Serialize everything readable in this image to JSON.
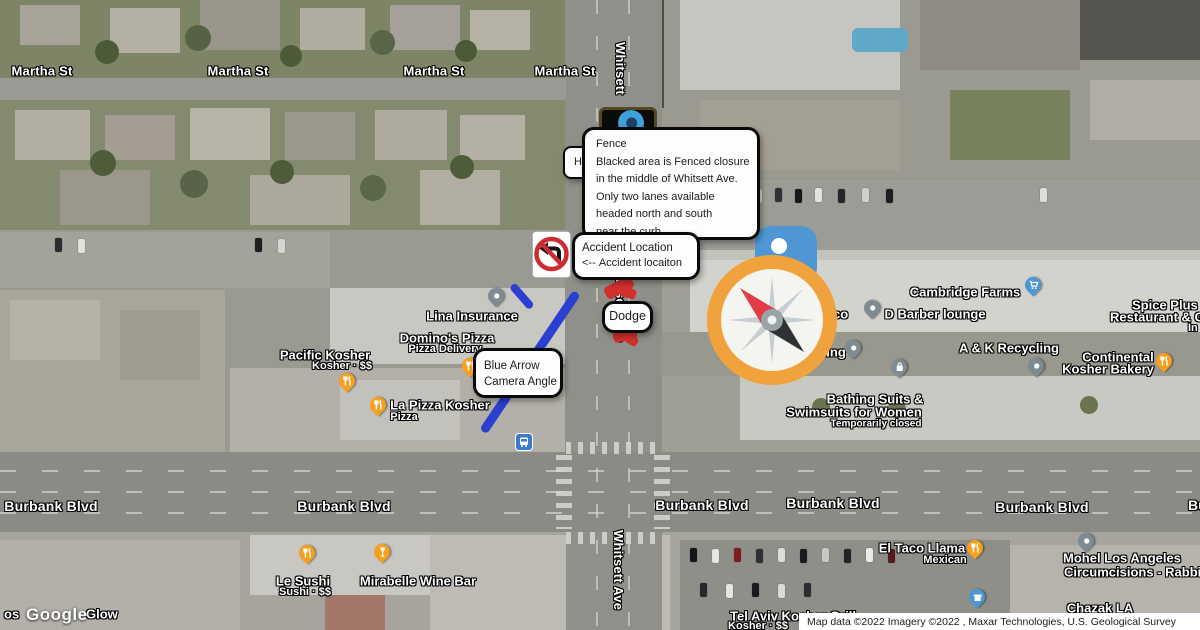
{
  "streets": {
    "martha": "Martha St",
    "burbank": "Burbank Blvd",
    "burbank_partial": "Bu",
    "whitsett_top": "Whitsett",
    "whitsett_mid": "Whitsett Ave",
    "whitsett_bottom": "Whitsett Ave"
  },
  "callouts": {
    "fence": {
      "title": "Fence",
      "line1": "Blacked area is Fenced closure",
      "line2": "in the middle of Whitsett Ave.",
      "line3": "Only two lanes available",
      "line4": "headed north and south",
      "line5": "near the curb"
    },
    "hidden_partial": "H",
    "accident": {
      "line1": "Accident Location",
      "arrow": "<--",
      "line2": "Accident locaiton"
    },
    "dodge": "Dodge",
    "camera": {
      "line1": "Blue Arrow",
      "line2": "Camera Angle"
    }
  },
  "pois": [
    {
      "name": "Lina Insurance"
    },
    {
      "name": "Domino's Pizza",
      "sub": "Pizza Delivery"
    },
    {
      "name": "Pacific Kosher",
      "sub": "Kosher · $$"
    },
    {
      "name": "La Pizza Kosher",
      "sub": "Pizza"
    },
    {
      "name": "Cambridge Farms"
    },
    {
      "name": "D Barber lounge"
    },
    {
      "name": "A & K Recycling"
    },
    {
      "name": "Continental",
      "name2": "Kosher Bakery"
    },
    {
      "name": "Spice Plus",
      "name2": "Restaurant & G",
      "name3": "In"
    },
    {
      "name": "Bathing Suits &",
      "name2": "Swimsuits for Women",
      "status": "Temporarily closed"
    },
    {
      "name": "El Taco Llama",
      "sub": "Mexican"
    },
    {
      "name": "Mohel Los Angeles",
      "name2": "Circumcisions - Rabbi."
    },
    {
      "name": "Chazak LA"
    },
    {
      "name": "Tel Aviv Kosher Grill",
      "sub": "Kosher · $$"
    },
    {
      "name": "Le Sushi",
      "sub": "Sushi · $$"
    },
    {
      "name": "Mirabelle Wine Bar"
    }
  ],
  "fragments": {
    "beside_compass": "co",
    "below_compass": "nting",
    "watermark_prefix": "os",
    "watermark_suffix": "Glow"
  },
  "watermark": "Google",
  "attribution": "Map data ©2022 Imagery ©2022 , Maxar Technologies, U.S. Geological Survey",
  "icons": {
    "compass": "compass-rose",
    "no_left_turn": "no-left-turn-sign",
    "bus": "bus-stop",
    "pin_food": "fork-knife",
    "pin_wine": "wine-glass",
    "pin_cart": "shopping-cart",
    "pin_bag": "shopping-bag",
    "pin_store": "storefront",
    "pin_generic": "dot"
  },
  "colors": {
    "compass_ring": "#F0A33C",
    "needle_red": "#E23C44",
    "needle_dark": "#2F3235",
    "arrow_blue": "#2B3FD0",
    "fence_black": "#0B0B09",
    "accident_red": "#D2302C",
    "pin_orange": "#F6A01F",
    "pin_gray": "#7E8B93",
    "pin_blue": "#4E97D4",
    "bus_blue": "#3D7BC9"
  }
}
